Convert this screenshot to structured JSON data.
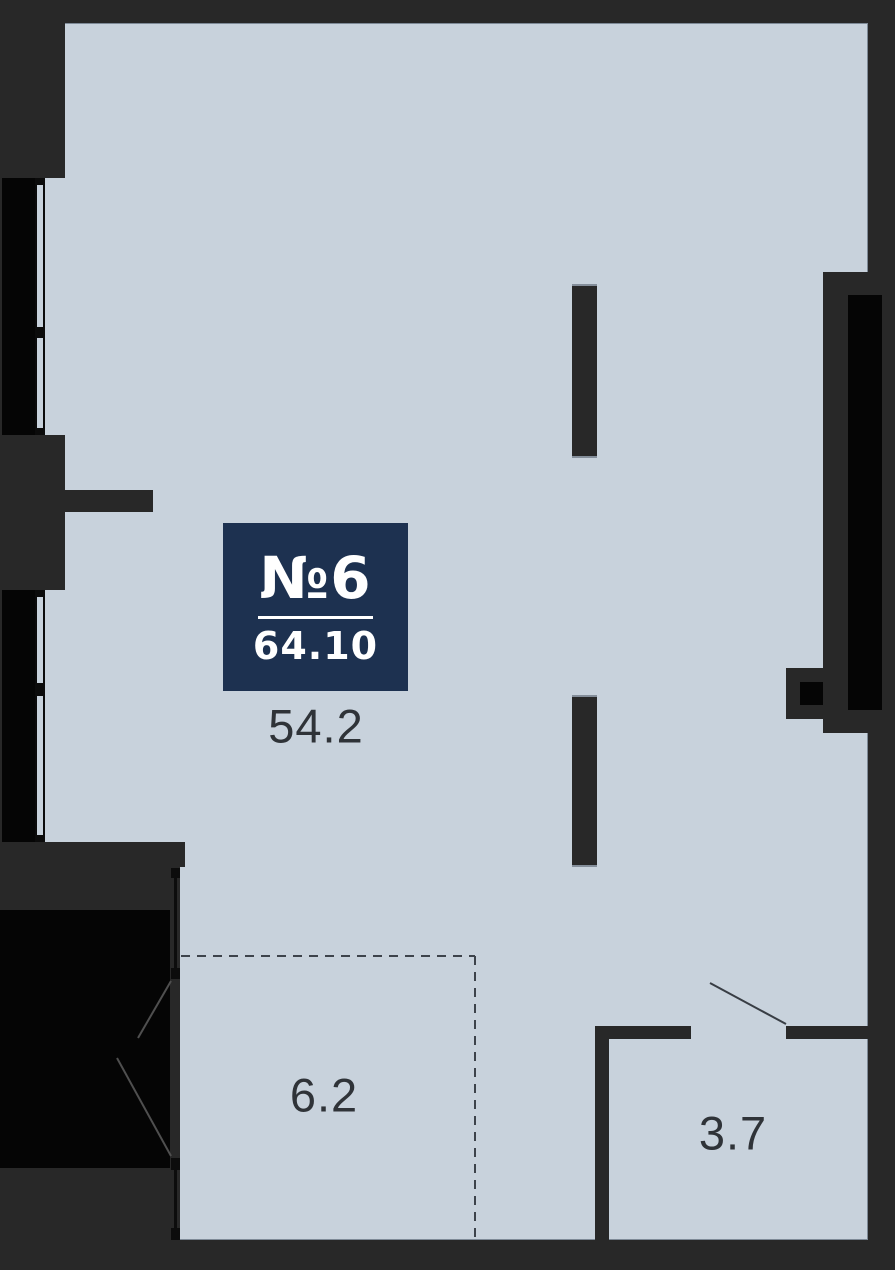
{
  "plan": {
    "badge": {
      "unit_label": "№6",
      "area_total": "64.10"
    },
    "areas": {
      "main_room": "54.2",
      "kitchen_zone": "6.2",
      "bathroom": "3.7"
    },
    "colors": {
      "floor": "#c8d2dc",
      "wall_dark": "#282828",
      "wall_black": "#050505",
      "badge_bg": "#1d3150",
      "badge_text": "#ffffff",
      "label_text": "#2f3338"
    }
  }
}
